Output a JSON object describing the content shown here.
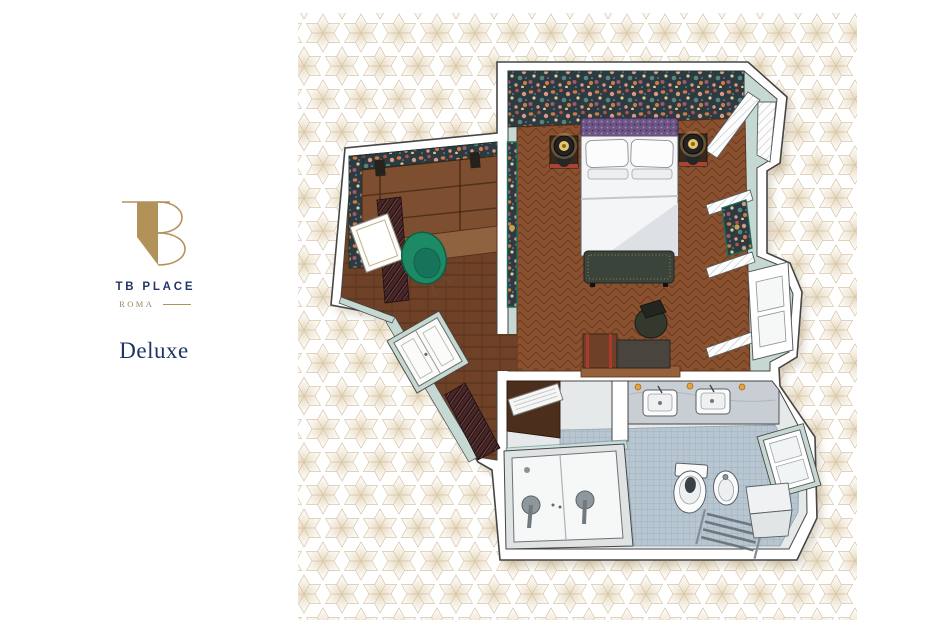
{
  "brand": {
    "name": "TB PLACE",
    "city": "ROMA",
    "monogram": "tb-monogram",
    "gold": "#b3925a",
    "navy": "#223768"
  },
  "room": {
    "label": "Deluxe"
  },
  "canvas": {
    "background": "#ffffff",
    "pattern_line": "#d8c5a8",
    "plan_outline": "#454545"
  },
  "floorplan": {
    "type": "isometric-floor-plan",
    "rooms": [
      {
        "name": "bedroom",
        "floor": "herringbone-wood",
        "features": [
          "floral-wallpaper-wall",
          "double-bed",
          "headboard",
          "pillows",
          "bedside-lamps",
          "nightstands",
          "foot-bench",
          "desk",
          "office-chair",
          "luggage-rack",
          "shuttered-windows",
          "radiator-cabinet",
          "artwork-panels"
        ]
      },
      {
        "name": "entry-closet",
        "floor": "wood-planks",
        "features": [
          "open-wardrobe-shelves",
          "framed-mirror",
          "green-armchair",
          "runner-rug",
          "entry-door",
          "doormat"
        ]
      },
      {
        "name": "bathroom",
        "floor": "mosaic-tile",
        "features": [
          "double-sinks",
          "gold-sconces",
          "bathtub",
          "glass-screen",
          "toilet",
          "bidet",
          "towel-ladder",
          "window",
          "marble-step",
          "towel-shelf"
        ]
      }
    ],
    "palette": {
      "mint_wall": "#c6d8d2",
      "teal_frame": "#1a6b5a",
      "wallpaper_base": "#2c3a42",
      "wood_floor": "#8a5130",
      "entry_floor": "#6f4126",
      "tile": "#b7c6d0",
      "armchair_green": "#1d8a66",
      "accent_red": "#ab3a2c",
      "lamp_gold": "#e9c86d"
    }
  }
}
